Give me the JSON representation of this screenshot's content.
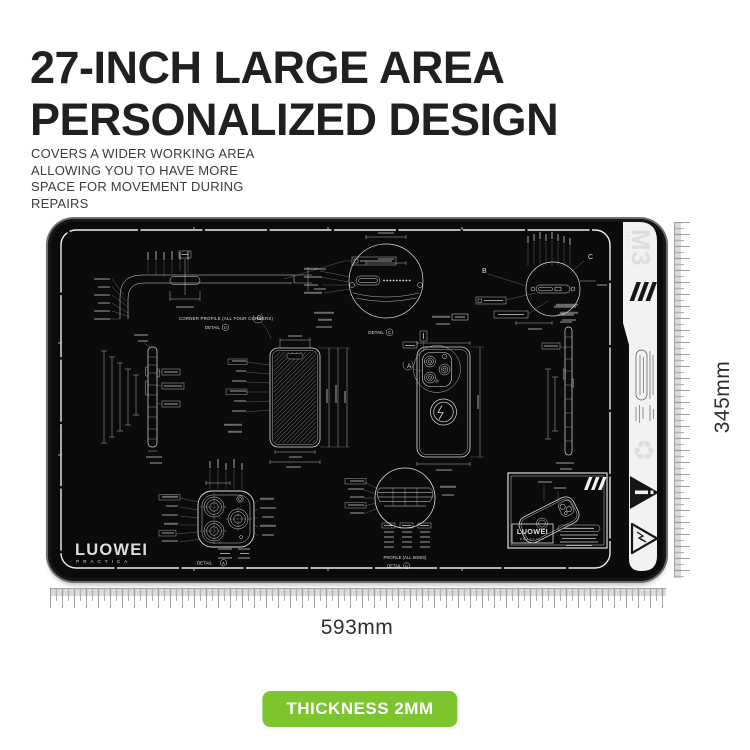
{
  "header": {
    "title_line1": "27-INCH LARGE AREA",
    "title_line2": "PERSONALIZED DESIGN",
    "subtitle_lines": [
      "COVERS A WIDER WORKING AREA",
      "ALLOWING YOU TO HAVE MORE",
      "SPACE FOR MOVEMENT DURING",
      "REPAIRS"
    ]
  },
  "mat": {
    "brand": "LUOWEI",
    "brand_sub": "PRACTICA",
    "model": "M3",
    "model_sub": "PRACTICA",
    "drawing_labels": {
      "detail_word": "DETAIL",
      "corner_profile": "CORNER PROFILE (ALL FOUR CORNERS)",
      "profile_all_sides": "PROFILE (ALL SIDES)",
      "callout_a": "A",
      "callout_b": "B",
      "callout_c": "C",
      "callout_d": "D"
    },
    "title_block": {
      "brand": "LUOWEI",
      "brand_sub": "PRACTICA"
    },
    "icons": {
      "recycle_glyph": "♻"
    }
  },
  "dimensions": {
    "width_label": "593mm",
    "height_label": "345mm"
  },
  "badge": {
    "label": "THICKNESS 2MM",
    "color": "#7cc52f"
  },
  "colors": {
    "mat_black": "#0b0b0b",
    "line_white": "#dcdcdc",
    "ruler_gray": "#b5b5b5",
    "accent_green": "#7cc52f",
    "title_black": "#221f1f"
  }
}
